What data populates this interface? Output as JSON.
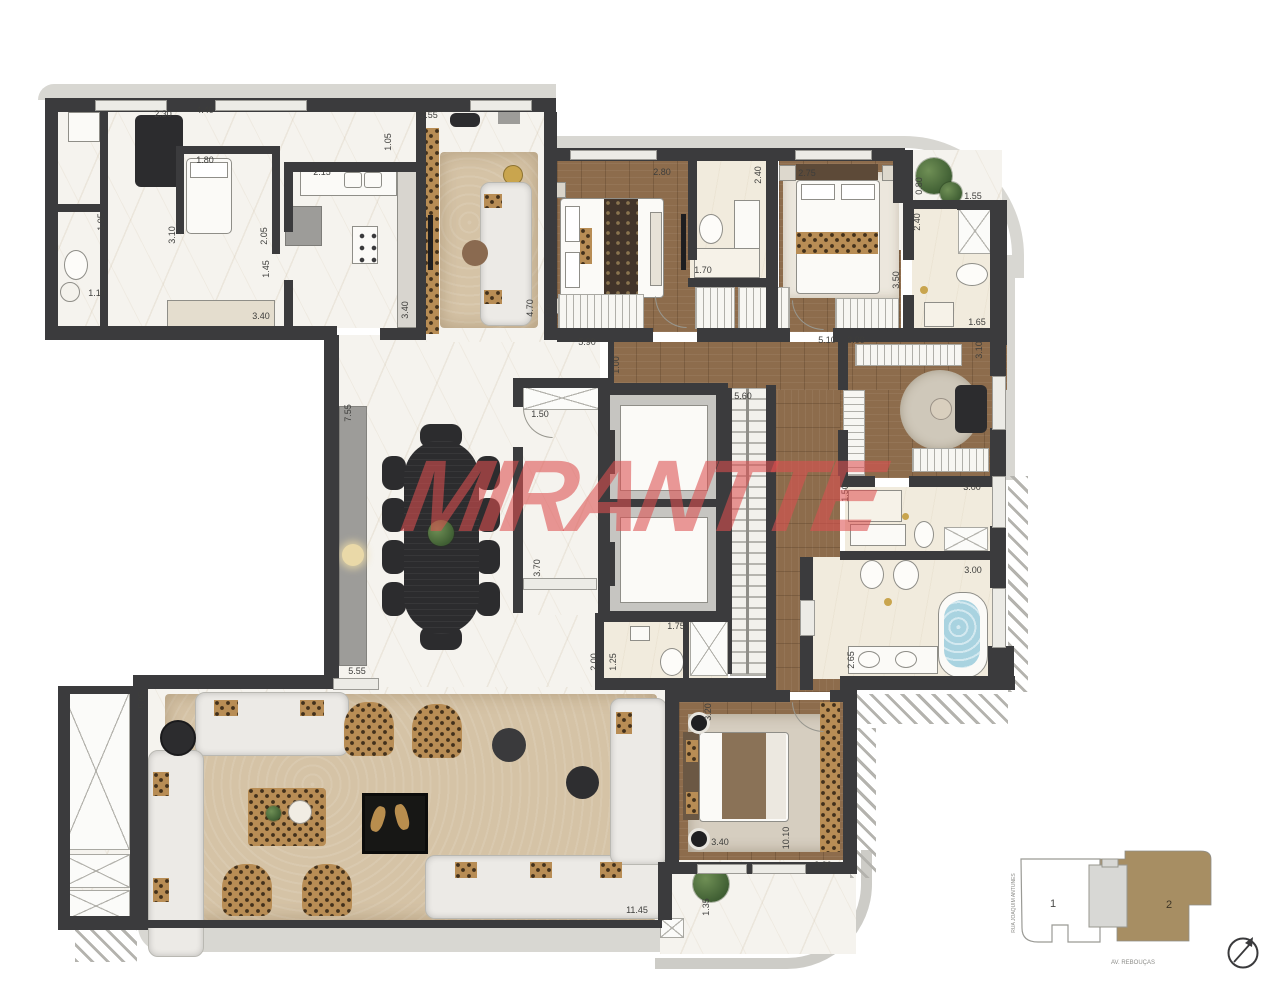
{
  "watermark": {
    "text": "MIRANTTE",
    "color": "#dd5050"
  },
  "key_plan": {
    "unit_1_label": "1",
    "unit_2_label": "2",
    "street_left": "RUA JOAQUIM ANTUNES",
    "street_bottom": "AV. REBOUÇAS",
    "highlight_color": "#a78e63"
  },
  "colors": {
    "wall": "#3b3b3d",
    "wood_floor": "#8d6c4c",
    "marble_floor": "#f5f3ee",
    "rug": "#d5c3a6"
  },
  "dimensions": [
    {
      "v": "2.30",
      "x": 163,
      "y": 114
    },
    {
      "v": "4.40",
      "x": 205,
      "y": 110
    },
    {
      "v": "1.80",
      "x": 205,
      "y": 160
    },
    {
      "v": "2.15",
      "x": 322,
      "y": 172
    },
    {
      "v": "2.55",
      "x": 429,
      "y": 115
    },
    {
      "v": "1.05",
      "x": 388,
      "y": 142,
      "r": 1
    },
    {
      "v": "1.95",
      "x": 101,
      "y": 222,
      "r": 1
    },
    {
      "v": "3.10",
      "x": 172,
      "y": 235,
      "r": 1
    },
    {
      "v": "2.05",
      "x": 264,
      "y": 236,
      "r": 1
    },
    {
      "v": "1.45",
      "x": 266,
      "y": 269,
      "r": 1
    },
    {
      "v": "1.10",
      "x": 97,
      "y": 293
    },
    {
      "v": "3.40",
      "x": 261,
      "y": 316
    },
    {
      "v": "3.40",
      "x": 405,
      "y": 310,
      "r": 1
    },
    {
      "v": "4.70",
      "x": 530,
      "y": 308,
      "r": 1
    },
    {
      "v": "3.50",
      "x": 549,
      "y": 313,
      "r": 1
    },
    {
      "v": "5.90",
      "x": 587,
      "y": 342
    },
    {
      "v": "2.80",
      "x": 662,
      "y": 172
    },
    {
      "v": "1.70",
      "x": 703,
      "y": 270
    },
    {
      "v": "2.40",
      "x": 758,
      "y": 175,
      "r": 1
    },
    {
      "v": "2.75",
      "x": 807,
      "y": 173
    },
    {
      "v": "0.80",
      "x": 919,
      "y": 186,
      "r": 1
    },
    {
      "v": "1.55",
      "x": 973,
      "y": 196
    },
    {
      "v": "2.40",
      "x": 917,
      "y": 222,
      "r": 1
    },
    {
      "v": "3.50",
      "x": 896,
      "y": 280,
      "r": 1
    },
    {
      "v": "1.65",
      "x": 977,
      "y": 322
    },
    {
      "v": "5.10",
      "x": 827,
      "y": 340
    },
    {
      "v": "3.00",
      "x": 856,
      "y": 340
    },
    {
      "v": "3.10",
      "x": 979,
      "y": 350,
      "r": 1
    },
    {
      "v": "1.00",
      "x": 616,
      "y": 365,
      "r": 1
    },
    {
      "v": "1.50",
      "x": 540,
      "y": 414
    },
    {
      "v": "5.60",
      "x": 743,
      "y": 396
    },
    {
      "v": "7.55",
      "x": 348,
      "y": 413,
      "r": 1
    },
    {
      "v": "3.70",
      "x": 537,
      "y": 568,
      "r": 1
    },
    {
      "v": "1.50",
      "x": 845,
      "y": 493,
      "r": 1
    },
    {
      "v": "3.00",
      "x": 972,
      "y": 487
    },
    {
      "v": "3.00",
      "x": 973,
      "y": 570
    },
    {
      "v": "1.75",
      "x": 676,
      "y": 626
    },
    {
      "v": "2.00",
      "x": 594,
      "y": 662,
      "r": 1
    },
    {
      "v": "1.25",
      "x": 613,
      "y": 662,
      "r": 1
    },
    {
      "v": "2.65",
      "x": 851,
      "y": 660,
      "r": 1
    },
    {
      "v": "5.55",
      "x": 357,
      "y": 671
    },
    {
      "v": "5.05",
      "x": 142,
      "y": 700,
      "r": 1
    },
    {
      "v": "3.20",
      "x": 708,
      "y": 712,
      "r": 1
    },
    {
      "v": "3.40",
      "x": 720,
      "y": 842
    },
    {
      "v": "10.10",
      "x": 786,
      "y": 838,
      "r": 1
    },
    {
      "v": "3.30",
      "x": 823,
      "y": 865
    },
    {
      "v": "1.35",
      "x": 706,
      "y": 907,
      "r": 1
    },
    {
      "v": "11.45",
      "x": 637,
      "y": 910
    }
  ]
}
